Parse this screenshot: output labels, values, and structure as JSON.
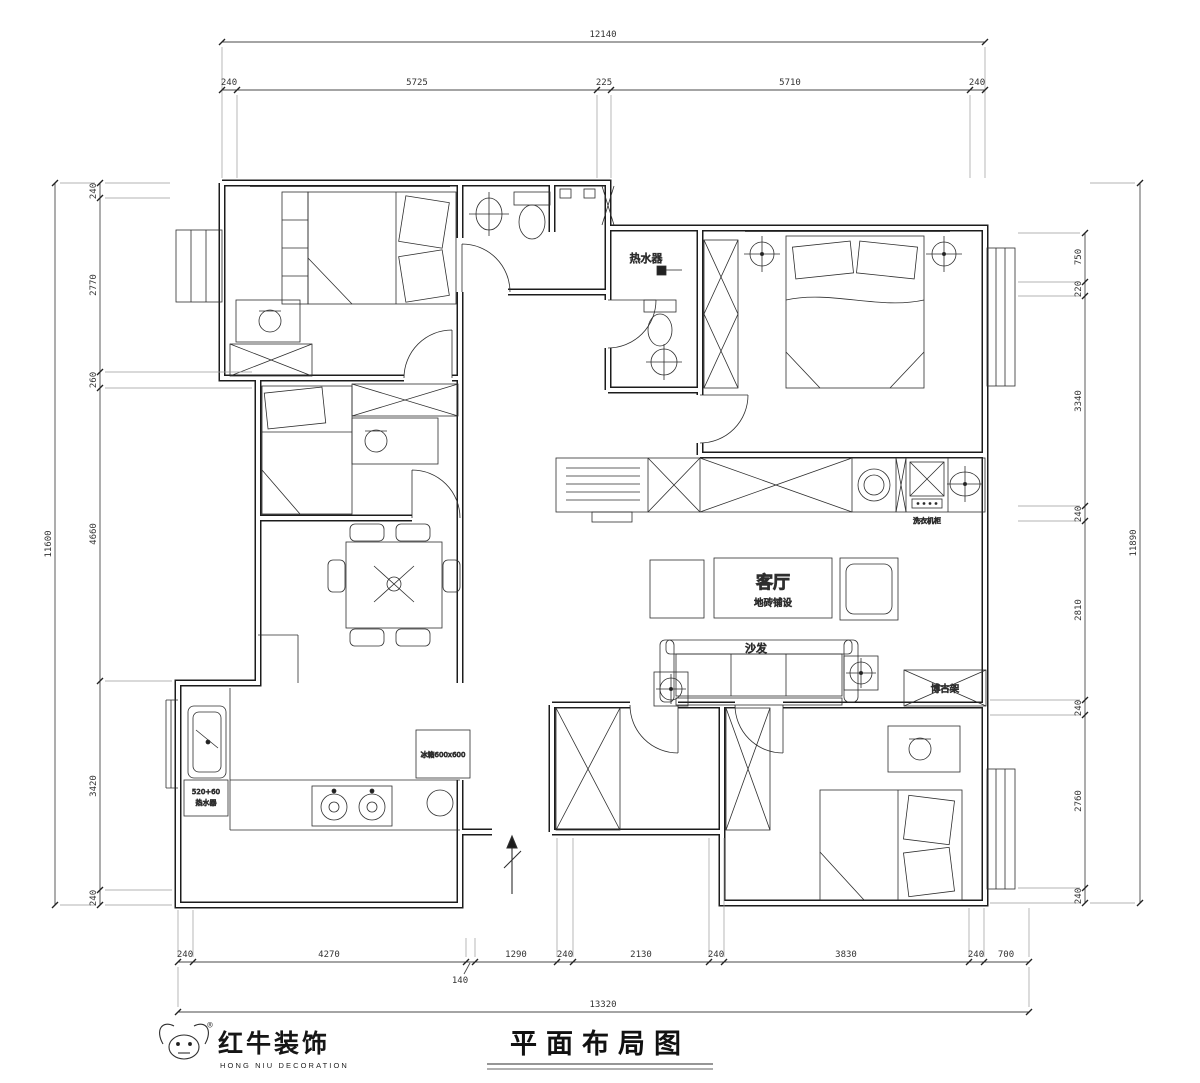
{
  "meta": {
    "title": "平面布局图"
  },
  "logo": {
    "name": "红牛装饰",
    "sub": "HONG NIU DECORATION",
    "reg": "®"
  },
  "dims": {
    "top_total": "12140",
    "top": [
      "240",
      "5725",
      "225",
      "5710",
      "240"
    ],
    "left_total": "11600",
    "left": [
      "240",
      "2770",
      "260",
      "4660",
      "3420",
      "240"
    ],
    "right_total": "11890",
    "right": [
      "750",
      "220",
      "3340",
      "240",
      "2810",
      "240",
      "2760",
      "240"
    ],
    "bottom": [
      "240",
      "4270",
      "140",
      "1290",
      "240",
      "2130",
      "240",
      "3830",
      "240",
      "700"
    ],
    "bottom_total": "13320"
  },
  "rooms": {
    "living": {
      "name": "客厅",
      "finish": "地砖铺设"
    },
    "sofa": "沙发",
    "curio": "博古架",
    "heater": "热水器",
    "laundry": "洗衣机柜",
    "fridge": "冰箱600x600",
    "kitchen_heater": [
      "520+60",
      "热水器"
    ]
  },
  "colors": {
    "line": "#1c1c1c",
    "dim": "#4a4a4a"
  }
}
